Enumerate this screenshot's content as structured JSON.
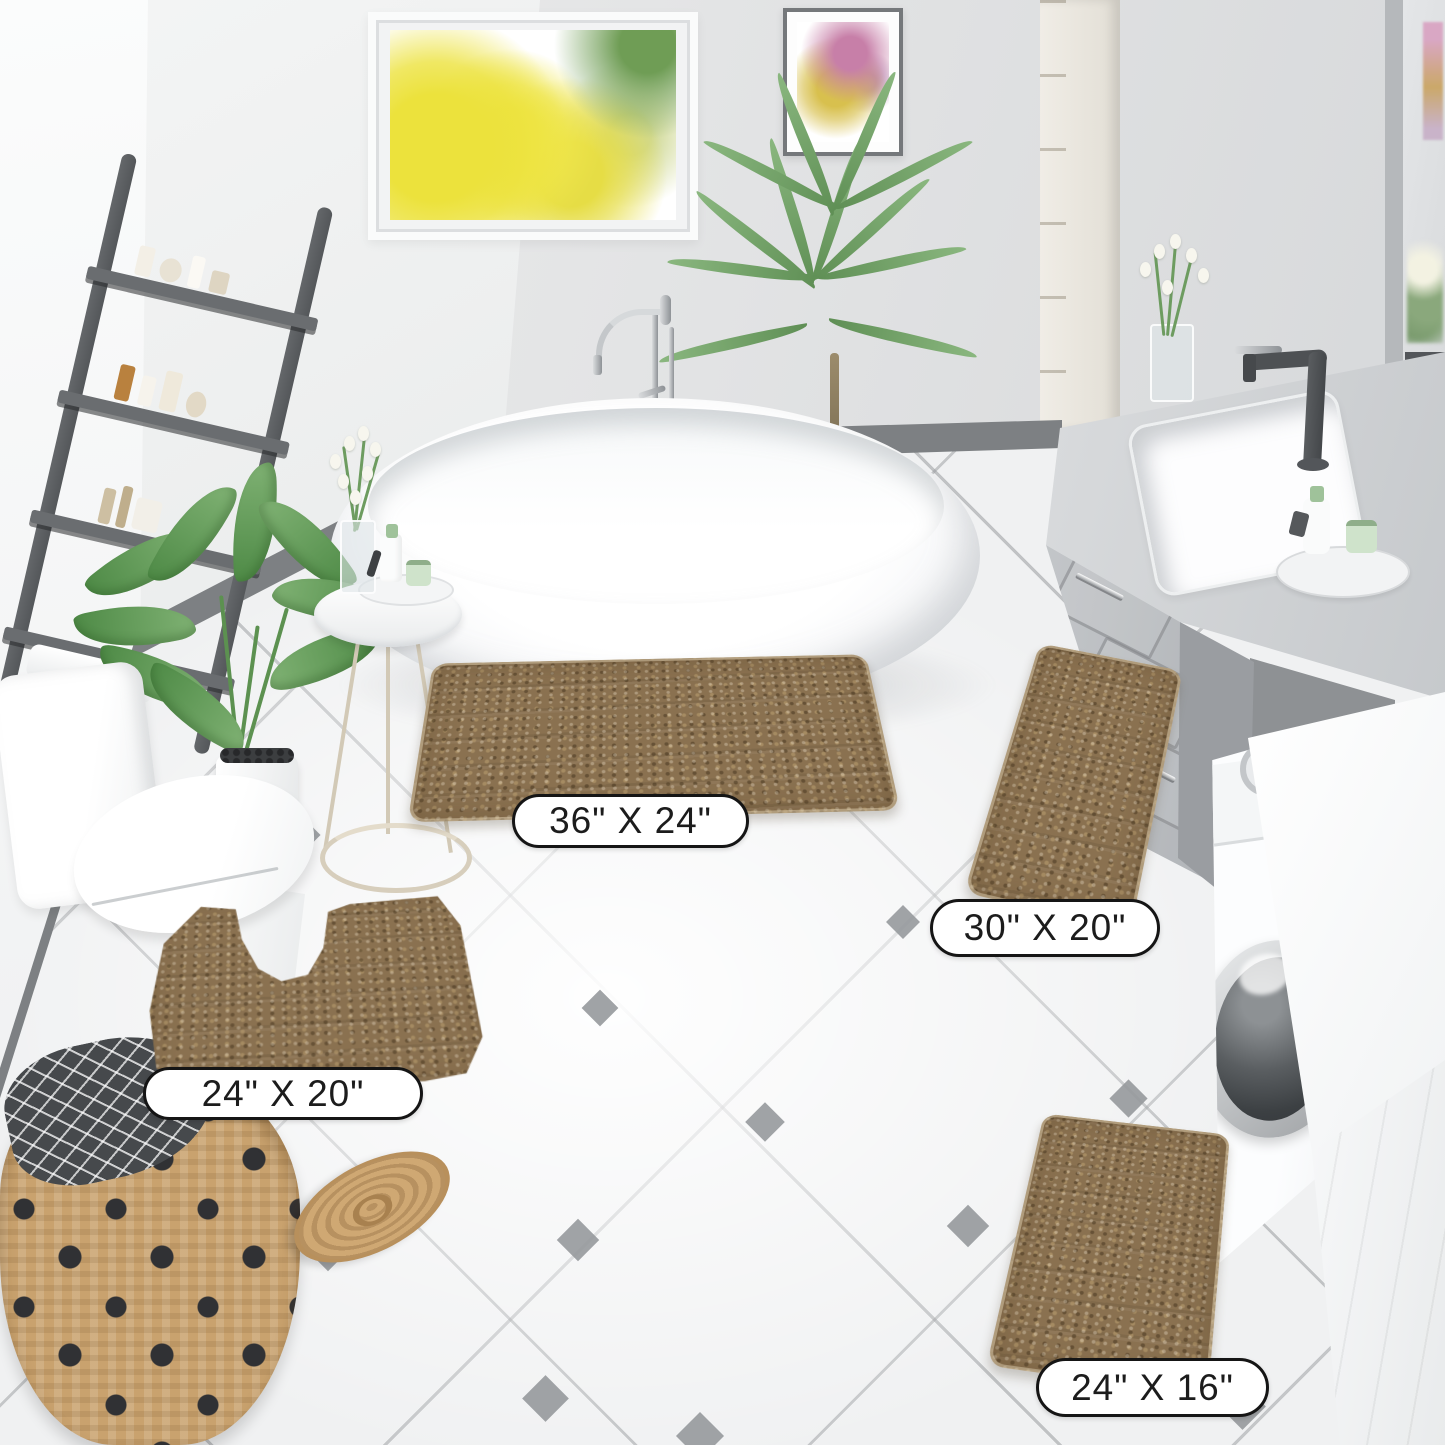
{
  "product_labels": {
    "mat_36x24": "36\" X 24\"",
    "mat_30x20": "30\" X 20\"",
    "mat_24x20": "24\" X 20\"",
    "mat_24x16": "24\" X 16\""
  },
  "palette": {
    "mat_brown": "#8a7150",
    "mat_brown_dark": "#6f5a3d",
    "mat_brown_light": "#a38a63",
    "floor_tile": "#f1f2f3",
    "grout": "#9a9da0",
    "diamond_accent": "#96999c",
    "baseboard": "#7d8083",
    "wall_left": "#f5f6f6",
    "wall_back": "#e0e1e3",
    "ladder": "#5d6063",
    "vanity_counter": "#d2d4d6",
    "vanity_cabinet": "#b3b6b9",
    "faucet_dark": "#4e5154",
    "label_border": "#151515",
    "label_text": "#1c1c1c"
  }
}
